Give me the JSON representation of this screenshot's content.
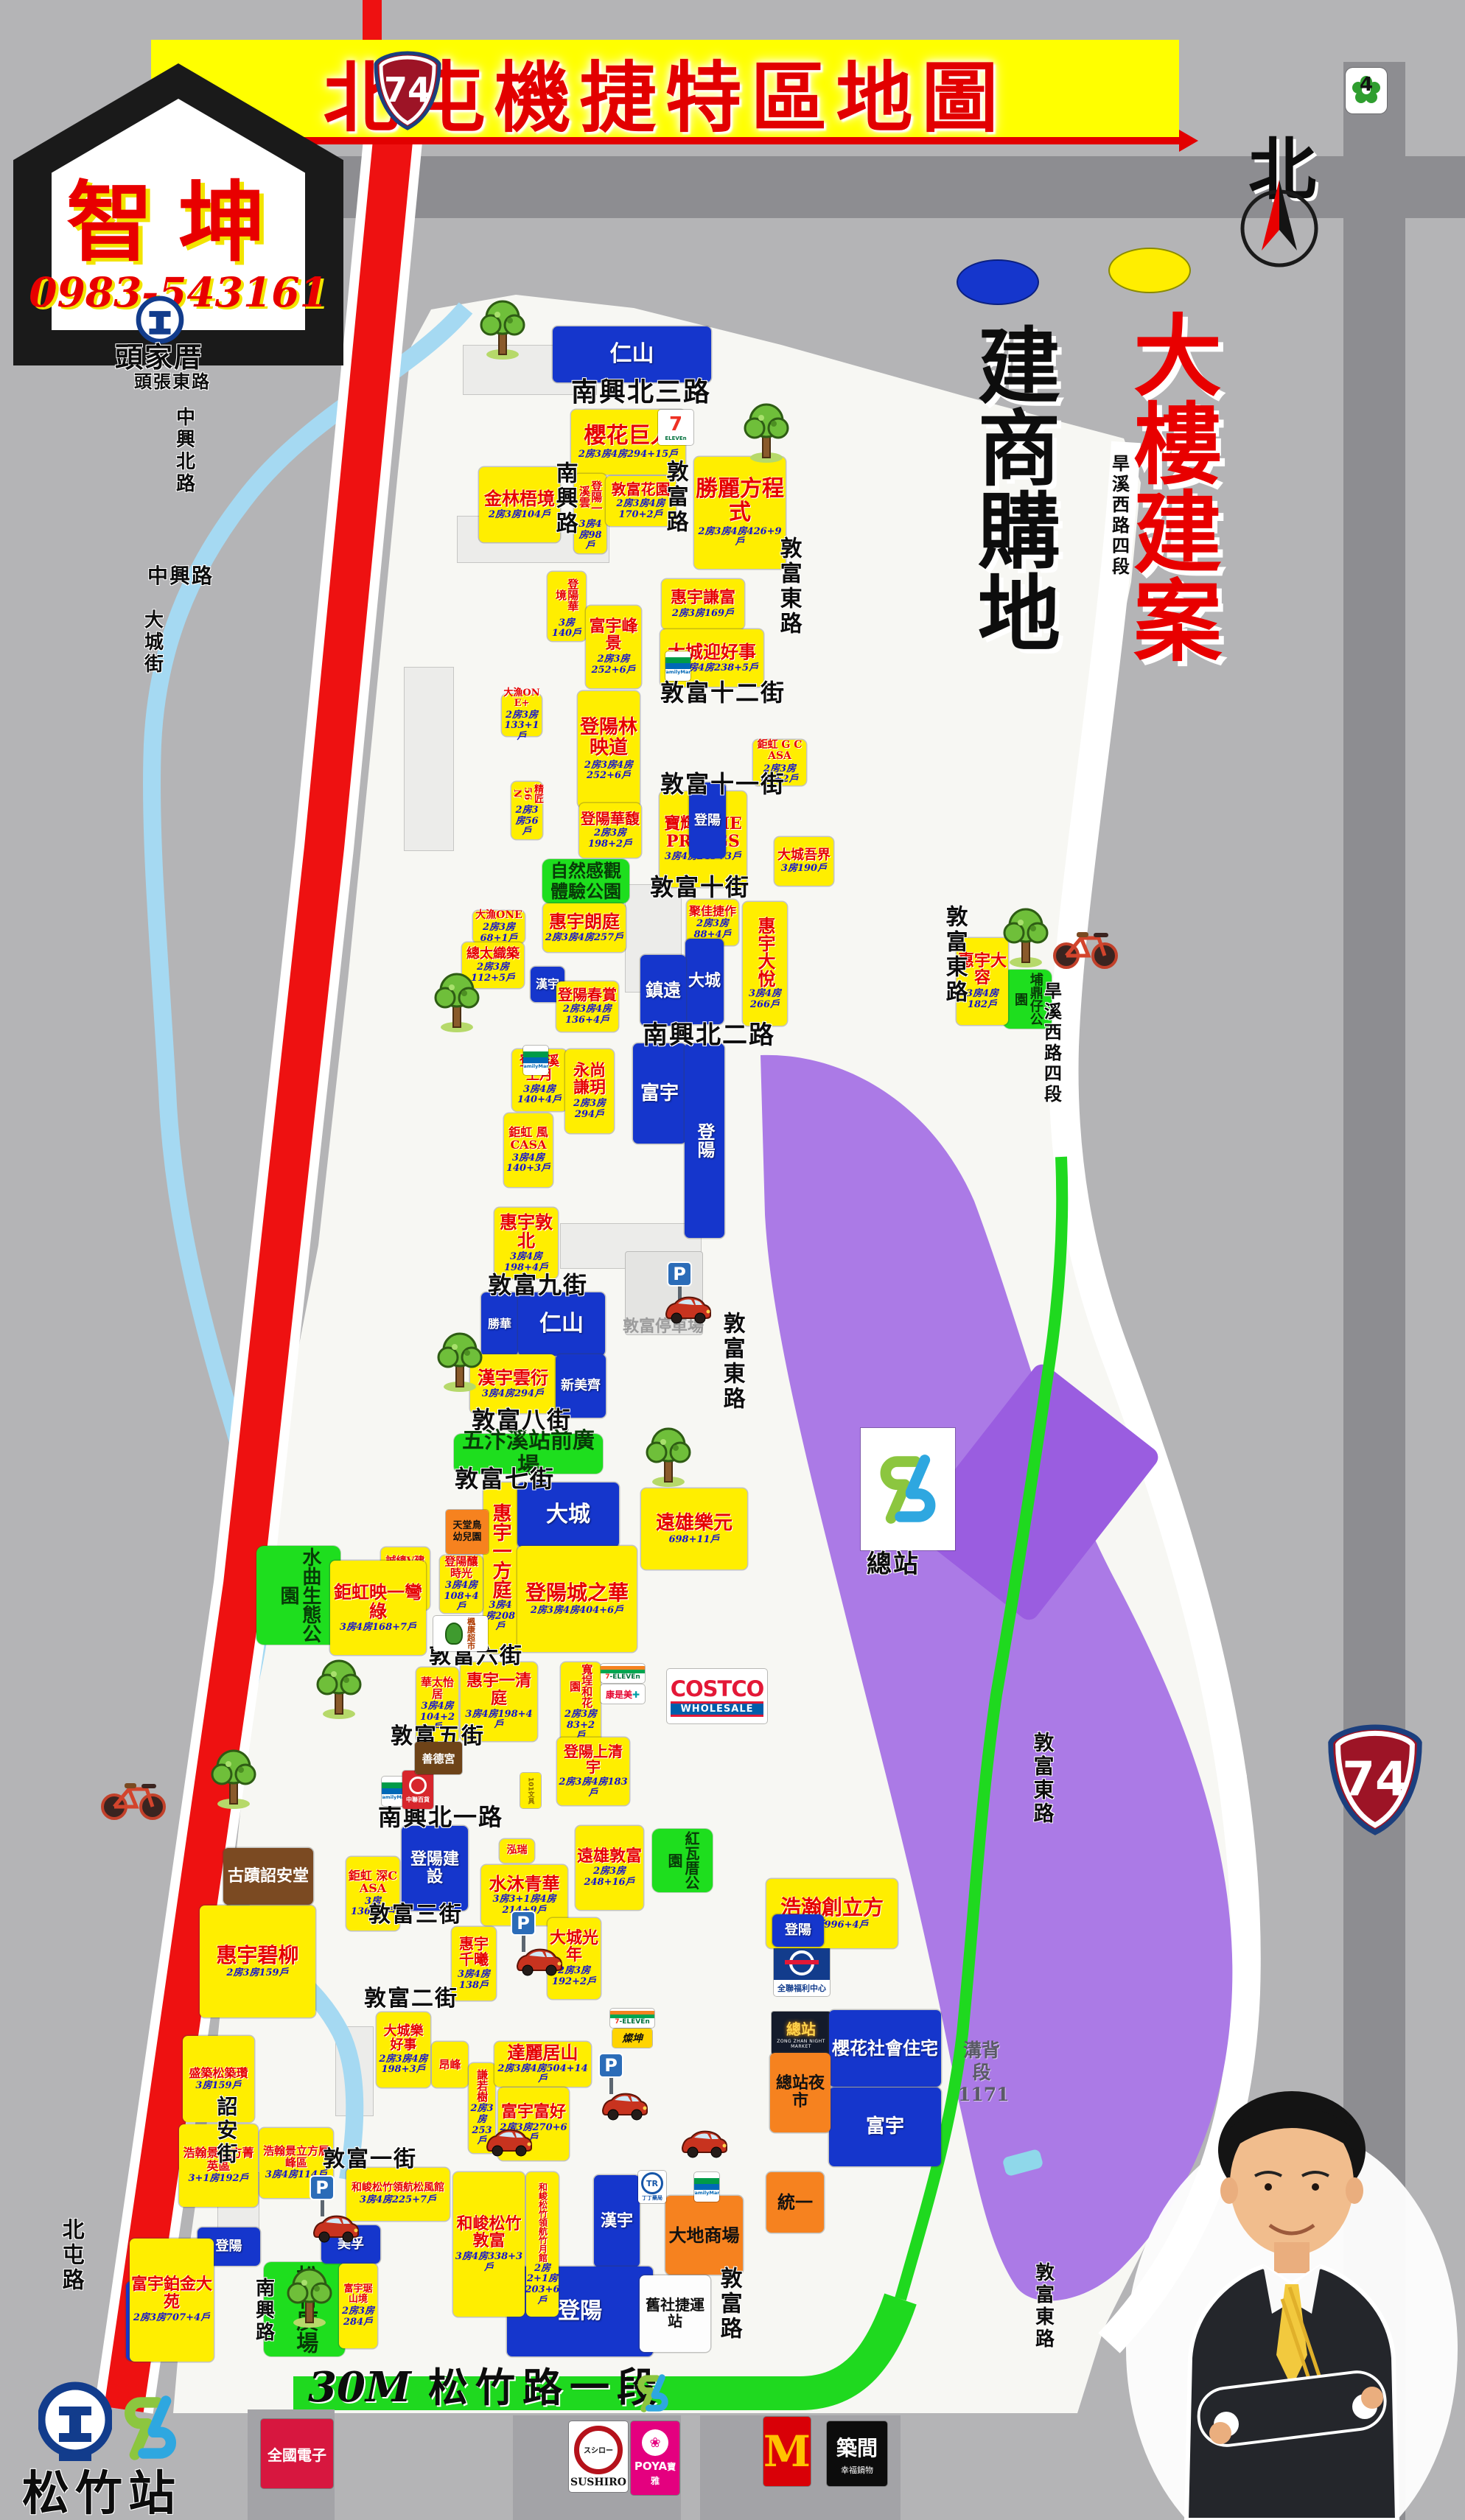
{
  "title": {
    "banner": "北屯機捷特區地圖"
  },
  "agency": {
    "name": "智坤",
    "phone": "0983-543161"
  },
  "badges": {
    "highway": "74",
    "city": "4"
  },
  "legend": {
    "blue": "建商購地",
    "yellow": "大樓建案",
    "north": "北"
  },
  "stations": {
    "tra_north": "頭家厝",
    "songzhu": "松竹站",
    "zongzhan": "總站",
    "scale": "30M",
    "songzhu_road": "松竹路一段"
  },
  "depot": {
    "label": "溝背段1171"
  },
  "parking": {
    "label": "敦富停車場"
  },
  "roads": [
    "南興北三路",
    "敦富路",
    "南興路",
    "敦富東路",
    "旱溪西路四段",
    "敦富十二街",
    "敦富十一街",
    "敦富十街",
    "南興北二路",
    "敦富東路",
    "旱溪西路四段",
    "敦富九街",
    "敦富東路",
    "敦富八街",
    "敦富七街",
    "敦富六街",
    "敦富五街",
    "南興北一路",
    "敦富三街",
    "敦富二街",
    "敦富一街",
    "中興北路",
    "中興路",
    "大城街",
    "北屯路",
    "詔安街",
    "南興路",
    "敦富路",
    "敦富東路",
    "敦富東路",
    "頭張東路"
  ],
  "parks": [
    "自然感觀體驗公園",
    "五汴溪站前廣場",
    "水曲生態公園",
    "紅瓦厝公園",
    "埔鼎仔公園",
    "松竹廣場"
  ],
  "projects": [
    {
      "name": "仁山",
      "units": ""
    },
    {
      "name": "櫻花巨人",
      "units": "2房3房4房294+15戶"
    },
    {
      "name": "金林梧境",
      "units": "2房3房104戶"
    },
    {
      "name": "登陽一溪雲",
      "units": "3房4房98戶"
    },
    {
      "name": "敦富花園",
      "units": "2房3房4房170+2戶"
    },
    {
      "name": "勝麗方程式",
      "units": "2房3房4房426+9戶"
    },
    {
      "name": "惠宇謙富",
      "units": "2房3房169戶"
    },
    {
      "name": "登陽華境",
      "units": "3房140戶"
    },
    {
      "name": "富宇峰景",
      "units": "2房3房252+6戶"
    },
    {
      "name": "大城迎好事",
      "units": "2房3房4房238+5戶"
    },
    {
      "name": "大漁ONE+",
      "units": "2房3房133+1戶"
    },
    {
      "name": "登陽林映道",
      "units": "2房3房4房252+6戶"
    },
    {
      "name": "鉅虹 G CASA",
      "units": "2房3房66+2戶"
    },
    {
      "name": "精匠56N",
      "units": "2房3房56戶"
    },
    {
      "name": "寶輝 THE PRINGS",
      "units": "3房4房245+3戶"
    },
    {
      "name": "登陽華馥",
      "units": "2房3房198+2戶"
    },
    {
      "name": "大城吾界",
      "units": "3房190戶"
    },
    {
      "name": "大漁ONE",
      "units": "2房3房68+1戶"
    },
    {
      "name": "總太織築",
      "units": "2房3房112+5戶"
    },
    {
      "name": "惠宇朗庭",
      "units": "2房3房4房257戶"
    },
    {
      "name": "漢宇",
      "units": ""
    },
    {
      "name": "登陽春賞",
      "units": "2房3房4房136+4戶"
    },
    {
      "name": "聚佳捷作",
      "units": "2房3房88+4戶"
    },
    {
      "name": "大城",
      "units": ""
    },
    {
      "name": "鎮遠",
      "units": ""
    },
    {
      "name": "惠宇大悅",
      "units": "3房4房266戶"
    },
    {
      "name": "惠宇大容",
      "units": "3房4房182戶"
    },
    {
      "name": "登陽溪上月",
      "units": "3房4房140+4戶"
    },
    {
      "name": "永尚謙玥",
      "units": "2房3房294戶"
    },
    {
      "name": "富宇",
      "units": ""
    },
    {
      "name": "登陽",
      "units": ""
    },
    {
      "name": "鉅虹 風CASA",
      "units": "3房4房140+3戶"
    },
    {
      "name": "惠宇敦北",
      "units": "3房4房198+4戶"
    },
    {
      "name": "勝華",
      "units": ""
    },
    {
      "name": "仁山",
      "units": ""
    },
    {
      "name": "漢宇雲衍",
      "units": "3房4房294戶"
    },
    {
      "name": "新美齊",
      "units": ""
    },
    {
      "name": "惠宇一方庭",
      "units": "3房4房208戶"
    },
    {
      "name": "大城",
      "units": ""
    },
    {
      "name": "登陽釀時光",
      "units": "3房4房108+4戶"
    },
    {
      "name": "登陽城之華",
      "units": "2房3房4房404+6戶"
    },
    {
      "name": "遠雄樂元",
      "units": "698+11戶"
    },
    {
      "name": "華太怡居",
      "units": "3房4房104+2戶"
    },
    {
      "name": "惠宇一清庭",
      "units": "3房4房198+4戶"
    },
    {
      "name": "寬埕和花園",
      "units": "2房3房83+2戶"
    },
    {
      "name": "登陽上清宇",
      "units": "2房3房4房183戶"
    },
    {
      "name": "鉅虹 深CASA",
      "units": "3房136+4戶"
    },
    {
      "name": "登陽建設",
      "units": ""
    },
    {
      "name": "泓瑞",
      "units": ""
    },
    {
      "name": "水沐青華",
      "units": "3房3+1房4房214+9戶"
    },
    {
      "name": "遠雄敦富",
      "units": "2房3房248+16戶"
    },
    {
      "name": "惠宇千曦",
      "units": "3房4房138戶"
    },
    {
      "name": "大城光年",
      "units": "2房3房192+2戶"
    },
    {
      "name": "惠宇碧柳",
      "units": "2房3房159戶"
    },
    {
      "name": "古蹟詔安堂",
      "units": ""
    },
    {
      "name": "盛築松築瓚",
      "units": "3房159戶"
    },
    {
      "name": "浩翰景立方菁英區",
      "units": "3+1房192戶"
    },
    {
      "name": "浩翰景立方層峰區",
      "units": "3房4房114戶"
    },
    {
      "name": "大城樂好事",
      "units": "2房3房4房198+3戶"
    },
    {
      "name": "昂峰",
      "units": ""
    },
    {
      "name": "謙若樹",
      "units": "2房3房253戶"
    },
    {
      "name": "達麗居山",
      "units": "2房3房4房504+14戶"
    },
    {
      "name": "富宇富好",
      "units": "2房3房270+6戶"
    },
    {
      "name": "浩瀚創立方",
      "units": "事務所996+4戶"
    },
    {
      "name": "登陽",
      "units": ""
    },
    {
      "name": "櫻花社會住宅",
      "units": ""
    },
    {
      "name": "富宇",
      "units": ""
    },
    {
      "name": "總站夜市",
      "units": ""
    },
    {
      "name": "統一",
      "units": ""
    },
    {
      "name": "大地商場",
      "units": ""
    },
    {
      "name": "漢宇",
      "units": ""
    },
    {
      "name": "登陽",
      "units": ""
    },
    {
      "name": "美孚",
      "units": ""
    },
    {
      "name": "登陽",
      "units": ""
    },
    {
      "name": "鴻邑",
      "units": ""
    },
    {
      "name": "富宇鉑金大苑",
      "units": "2房3房707+4戶"
    },
    {
      "name": "和峻松竹領航松風館",
      "units": "3房4房225+7戶"
    },
    {
      "name": "和峻松竹敦富",
      "units": "3房4房338+3戶"
    },
    {
      "name": "和峻松竹領航竹月館",
      "units": "2房2+1房203+6戶"
    },
    {
      "name": "富宇琚山境",
      "units": "2房3房284戶"
    },
    {
      "name": "舊社捷運站",
      "units": ""
    },
    {
      "name": "誠總V建築",
      "units": "2房3房81+4戶"
    },
    {
      "name": "鉅虹映一彎綠",
      "units": "3房4房168+7戶"
    },
    {
      "name": "登陽",
      "units": ""
    }
  ],
  "brands": {
    "seven": "7-ELEVEN",
    "family": "FamilyMart",
    "costco1": "COSTCO",
    "costco2": "WHOLESALE",
    "pxmart": "全聯福利中心",
    "fengkang": "楓康超市",
    "zhonglian": "中聯百貨",
    "tr_abbr": "TR",
    "tr_name": "丁丁藥局",
    "tsannkuen": "燦坤",
    "cosmed": "康是美",
    "stationery": "101文具",
    "temple": "善德宮",
    "kindergarten": "天堂鳥幼兒園",
    "night1": "總站",
    "night2": "ZONG ZHAN NIGHT MARKET",
    "mcd": "M",
    "poya1": "POYA",
    "poya2": "寶雅",
    "sushiro1": "スシロー",
    "sushiro2": "SUSHIRO",
    "zhujian1": "築間",
    "zhujian2": "幸福鍋物",
    "elifemall": "全國電子"
  }
}
